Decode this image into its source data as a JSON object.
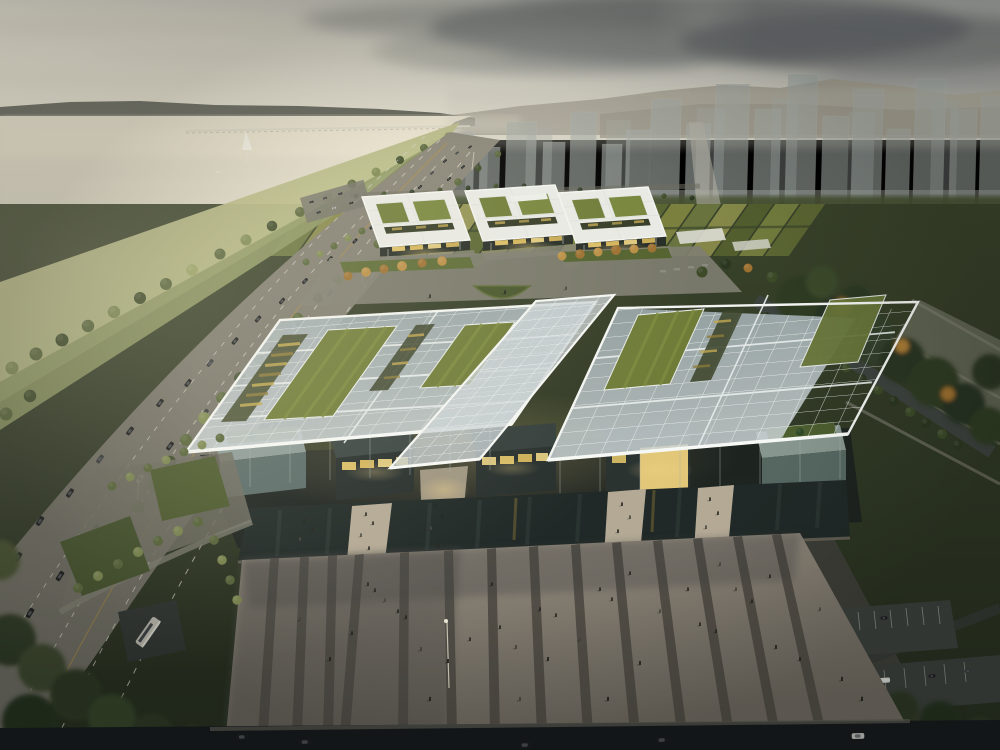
{
  "scene": {
    "type": "architectural-rendering",
    "description": "Aerial dusk rendering of a lakeside civic campus: a large low-rise exhibition complex under a translucent glass grid canopy with sunken green-roof courtyards and glowing interiors, a rear row of three white-canopied office blocks, a striped pedestrian plaza with scattered people, a multi-lane lakeshore highway with traffic on the left, farmland strips and a translucent high-rise skyline with mountains on the horizon",
    "time_of_day": "dusk",
    "camera": "high oblique aerial view"
  },
  "inventory": {
    "lake": {
      "boats": 2,
      "bridge_crossings": 1,
      "mist": true
    },
    "highway": {
      "lanes_visible": 8,
      "vehicles": 38,
      "street_lights": 6
    },
    "skyline": {
      "towers": 18,
      "style": "translucent massing volumes"
    },
    "farmland": {
      "strips": 20
    },
    "rear_complex": {
      "blocks": 3,
      "green_roof_courts_per_block": 2,
      "lit_facades": true
    },
    "main_complex": {
      "canopies": 3,
      "green_roof_courts": 4,
      "louver_strips": 3,
      "reflecting_pools": 1,
      "walkway_bridges": 4,
      "support_columns": 16
    },
    "plaza": {
      "paving_stripes": 11,
      "pedestrians": 46,
      "lamp_posts": 1
    },
    "east_grounds": {
      "parking_lots": 3,
      "tree_belt": true,
      "paths": 4
    },
    "west_corner": {
      "shuttle_bus": 1,
      "hedge_rows": 3
    },
    "south_road": {
      "cars": 5
    }
  },
  "palette": {
    "sky-warm": "#f1ecda",
    "sky-mid": "#d9d6c9",
    "sky-gray": "#9b9d9a",
    "cloud-dark": "#656a6a",
    "cloud-mid": "#8b8e8b",
    "cloud-pale": "#cfcaba",
    "ridge": "#5e6057",
    "mtn": "#a39e90",
    "mtn2": "#938e81",
    "water-top": "#e9e3d0",
    "water-bot": "#bfbdb0",
    "tower": "#a0a8a4",
    "city-base": "#44502e",
    "site": "#39422a",
    "site-dark": "#232b1d",
    "hwy": "#8b8779",
    "hwy-dark": "#5e5d55",
    "lane": "#d9d7cb",
    "bank-hi": "#b7ba86",
    "bank-lo": "#8c9660",
    "slab": "#e9eae5",
    "slab-shade": "#c7cac2",
    "facade": "#262d26",
    "amber": "#e9cb6b",
    "teal-top": "#8b9a96",
    "teal-face": "#5a6b68",
    "glass-hi": "#cbd3d5",
    "glass-lo": "#9fadb2",
    "glass-c": "#ccd4d6",
    "grid": "#eef2f0",
    "court": "#6f7c38",
    "court2": "#7e8c40",
    "slot": "#3e462c",
    "louver": "#c2a851",
    "pool": "#202927",
    "walk": "#b3a995",
    "plaza-hi": "#958d80",
    "plaza-lo": "#6b665d",
    "stripe": "#4a463f",
    "south-road": "#14181a",
    "pave": "#807e71"
  }
}
